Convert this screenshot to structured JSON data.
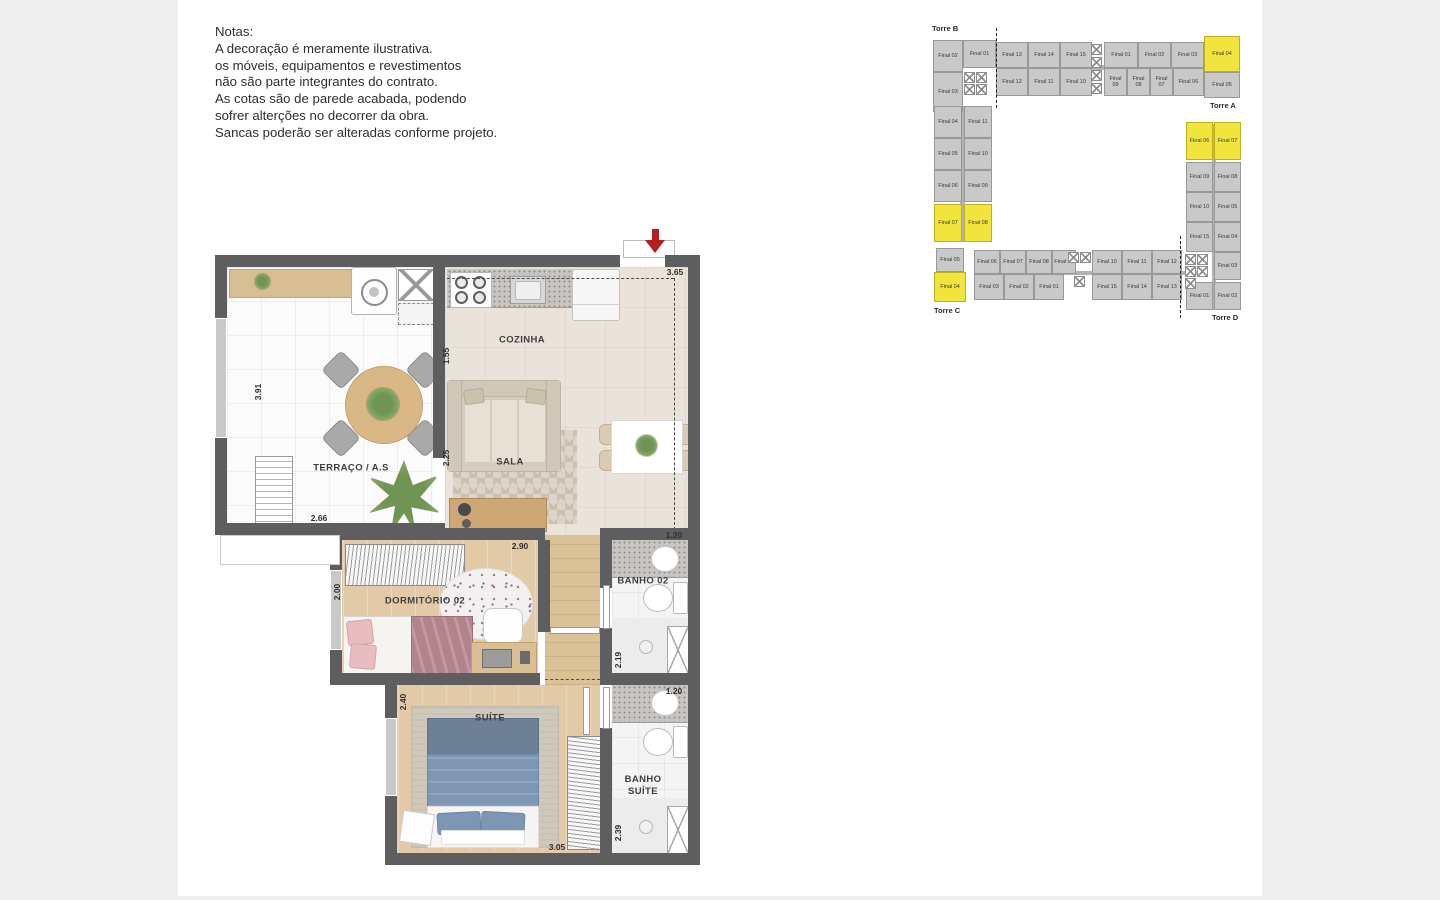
{
  "notes": {
    "title": "Notas:",
    "lines": [
      "A decoração é meramente ilustrativa.",
      "os móveis, equipamentos e revestimentos",
      "não são parte integrantes do contrato.",
      "As cotas são de parede acabada, podendo",
      "sofrer alterções no decorrer da obra.",
      "Sancas poderão ser alteradas conforme projeto."
    ]
  },
  "floor_plan": {
    "entrance_arrow_color": "#b2201f",
    "rooms": {
      "terraco": "TERRAÇO / A.S",
      "cozinha": "COZINHA",
      "sala": "SALA",
      "dormitorio2": "DORMITÓRIO 02",
      "banho2": "BANHO 02",
      "suite": "SUÍTE",
      "banho_suite": "BANHO SUÍTE"
    },
    "dimensions": {
      "entry_width": "3.65",
      "terraco_height": "3.91",
      "terraco_width": "2.66",
      "cozinha_depth": "1.55",
      "sala_depth": "2.25",
      "dorm2_left": "2.00",
      "dorm2_width": "2.90",
      "banho2_width": "1.20",
      "banho2_height": "2.19",
      "suite_height": "2.40",
      "suite_width": "3.05",
      "banho_suite_width": "1.20",
      "banho_suite_height": "2.39"
    }
  },
  "key_plan": {
    "unit_fill": "#c9c9c9",
    "highlight_fill": "#f1e43c",
    "towers": [
      {
        "label": "Torre B",
        "x": 2,
        "y": 2
      },
      {
        "label": "Torre A",
        "x": 280,
        "y": 79
      },
      {
        "label": "Torre C",
        "x": 4,
        "y": 284
      },
      {
        "label": "Torre D",
        "x": 282,
        "y": 291
      }
    ],
    "units": [
      {
        "label": "Final 02",
        "x": 3,
        "y": 18,
        "w": 30,
        "h": 32,
        "hl": false
      },
      {
        "label": "Final 01",
        "x": 33,
        "y": 18,
        "w": 33,
        "h": 28,
        "hl": false
      },
      {
        "label": "Final 13",
        "x": 66,
        "y": 20,
        "w": 32,
        "h": 26,
        "hl": false
      },
      {
        "label": "Final 14",
        "x": 98,
        "y": 20,
        "w": 32,
        "h": 26,
        "hl": false
      },
      {
        "label": "Final 15",
        "x": 130,
        "y": 20,
        "w": 32,
        "h": 26,
        "hl": false
      },
      {
        "label": "Final 01",
        "x": 174,
        "y": 20,
        "w": 34,
        "h": 26,
        "hl": false
      },
      {
        "label": "Final 02",
        "x": 208,
        "y": 20,
        "w": 33,
        "h": 26,
        "hl": false
      },
      {
        "label": "Final 03",
        "x": 241,
        "y": 20,
        "w": 33,
        "h": 26,
        "hl": false
      },
      {
        "label": "Final 04",
        "x": 274,
        "y": 14,
        "w": 36,
        "h": 36,
        "hl": true
      },
      {
        "label": "Final 03",
        "x": 3,
        "y": 50,
        "w": 30,
        "h": 40,
        "hl": false
      },
      {
        "label": "Final 12",
        "x": 66,
        "y": 46,
        "w": 32,
        "h": 28,
        "hl": false
      },
      {
        "label": "Final 11",
        "x": 98,
        "y": 46,
        "w": 32,
        "h": 28,
        "hl": false
      },
      {
        "label": "Final 10",
        "x": 130,
        "y": 46,
        "w": 32,
        "h": 28,
        "hl": false
      },
      {
        "label": "Final 09",
        "x": 174,
        "y": 46,
        "w": 23,
        "h": 28,
        "hl": false
      },
      {
        "label": "Final 08",
        "x": 197,
        "y": 46,
        "w": 23,
        "h": 28,
        "hl": false
      },
      {
        "label": "Final 07",
        "x": 220,
        "y": 46,
        "w": 23,
        "h": 28,
        "hl": false
      },
      {
        "label": "Final 06",
        "x": 243,
        "y": 46,
        "w": 31,
        "h": 28,
        "hl": false
      },
      {
        "label": "Final 05",
        "x": 274,
        "y": 50,
        "w": 36,
        "h": 26,
        "hl": false
      },
      {
        "label": "Final 04",
        "x": 4,
        "y": 84,
        "w": 28,
        "h": 32,
        "hl": false
      },
      {
        "label": "Final 11",
        "x": 34,
        "y": 84,
        "w": 28,
        "h": 32,
        "hl": false
      },
      {
        "label": "Final 05",
        "x": 4,
        "y": 116,
        "w": 28,
        "h": 32,
        "hl": false
      },
      {
        "label": "Final 10",
        "x": 34,
        "y": 116,
        "w": 28,
        "h": 32,
        "hl": false
      },
      {
        "label": "Final 06",
        "x": 4,
        "y": 148,
        "w": 28,
        "h": 32,
        "hl": false
      },
      {
        "label": "Final 09",
        "x": 34,
        "y": 148,
        "w": 28,
        "h": 32,
        "hl": false
      },
      {
        "label": "Final 07",
        "x": 4,
        "y": 182,
        "w": 28,
        "h": 38,
        "hl": true
      },
      {
        "label": "Final 08",
        "x": 34,
        "y": 182,
        "w": 28,
        "h": 38,
        "hl": true
      },
      {
        "label": "Final 06",
        "x": 256,
        "y": 100,
        "w": 27,
        "h": 38,
        "hl": true
      },
      {
        "label": "Final 07",
        "x": 284,
        "y": 100,
        "w": 27,
        "h": 38,
        "hl": true
      },
      {
        "label": "Final 09",
        "x": 256,
        "y": 140,
        "w": 27,
        "h": 30,
        "hl": false
      },
      {
        "label": "Final 08",
        "x": 284,
        "y": 140,
        "w": 27,
        "h": 30,
        "hl": false
      },
      {
        "label": "Final 10",
        "x": 256,
        "y": 170,
        "w": 27,
        "h": 30,
        "hl": false
      },
      {
        "label": "Final 05",
        "x": 284,
        "y": 170,
        "w": 27,
        "h": 30,
        "hl": false
      },
      {
        "label": "Final 15",
        "x": 256,
        "y": 200,
        "w": 27,
        "h": 30,
        "hl": false
      },
      {
        "label": "Final 04",
        "x": 284,
        "y": 200,
        "w": 27,
        "h": 30,
        "hl": false
      },
      {
        "label": "Final 03",
        "x": 284,
        "y": 230,
        "w": 27,
        "h": 28,
        "hl": false
      },
      {
        "label": "Final 01",
        "x": 256,
        "y": 260,
        "w": 27,
        "h": 28,
        "hl": false
      },
      {
        "label": "Final 02",
        "x": 284,
        "y": 260,
        "w": 27,
        "h": 28,
        "hl": false
      },
      {
        "label": "Final 05",
        "x": 6,
        "y": 226,
        "w": 28,
        "h": 24,
        "hl": false
      },
      {
        "label": "Final 04",
        "x": 4,
        "y": 250,
        "w": 32,
        "h": 30,
        "hl": true
      },
      {
        "label": "Final 06",
        "x": 44,
        "y": 228,
        "w": 26,
        "h": 24,
        "hl": false
      },
      {
        "label": "Final 07",
        "x": 70,
        "y": 228,
        "w": 26,
        "h": 24,
        "hl": false
      },
      {
        "label": "Final 08",
        "x": 96,
        "y": 228,
        "w": 26,
        "h": 24,
        "hl": false
      },
      {
        "label": "Final 09",
        "x": 122,
        "y": 228,
        "w": 24,
        "h": 24,
        "hl": false
      },
      {
        "label": "Final 10",
        "x": 162,
        "y": 228,
        "w": 30,
        "h": 24,
        "hl": false
      },
      {
        "label": "Final 11",
        "x": 192,
        "y": 228,
        "w": 30,
        "h": 24,
        "hl": false
      },
      {
        "label": "Final 12",
        "x": 222,
        "y": 228,
        "w": 30,
        "h": 24,
        "hl": false
      },
      {
        "label": "Final 03",
        "x": 44,
        "y": 252,
        "w": 30,
        "h": 26,
        "hl": false
      },
      {
        "label": "Final 02",
        "x": 74,
        "y": 252,
        "w": 30,
        "h": 26,
        "hl": false
      },
      {
        "label": "Final 01",
        "x": 104,
        "y": 252,
        "w": 30,
        "h": 26,
        "hl": false
      },
      {
        "label": "Final 15",
        "x": 162,
        "y": 252,
        "w": 30,
        "h": 26,
        "hl": false
      },
      {
        "label": "Final 14",
        "x": 192,
        "y": 252,
        "w": 30,
        "h": 26,
        "hl": false
      },
      {
        "label": "Final 13",
        "x": 222,
        "y": 252,
        "w": 30,
        "h": 26,
        "hl": false
      }
    ],
    "elevators": [
      {
        "x": 34,
        "y": 50
      },
      {
        "x": 46,
        "y": 50
      },
      {
        "x": 34,
        "y": 62
      },
      {
        "x": 46,
        "y": 62
      },
      {
        "x": 161,
        "y": 22
      },
      {
        "x": 161,
        "y": 35
      },
      {
        "x": 161,
        "y": 48
      },
      {
        "x": 161,
        "y": 61
      },
      {
        "x": 138,
        "y": 230
      },
      {
        "x": 150,
        "y": 230
      },
      {
        "x": 144,
        "y": 254
      },
      {
        "x": 255,
        "y": 232
      },
      {
        "x": 267,
        "y": 232
      },
      {
        "x": 255,
        "y": 244
      },
      {
        "x": 267,
        "y": 244
      },
      {
        "x": 255,
        "y": 256
      }
    ],
    "dashes": [
      {
        "x": 66,
        "y": 6,
        "h": 80
      },
      {
        "x": 250,
        "y": 214,
        "h": 82
      }
    ],
    "corridors": [
      {
        "x": 66,
        "y": 43,
        "w": 208,
        "h": 5
      },
      {
        "x": 30,
        "y": 84,
        "w": 5,
        "h": 136
      },
      {
        "x": 282,
        "y": 102,
        "w": 4,
        "h": 186
      },
      {
        "x": 44,
        "y": 249,
        "w": 230,
        "h": 4
      }
    ]
  }
}
